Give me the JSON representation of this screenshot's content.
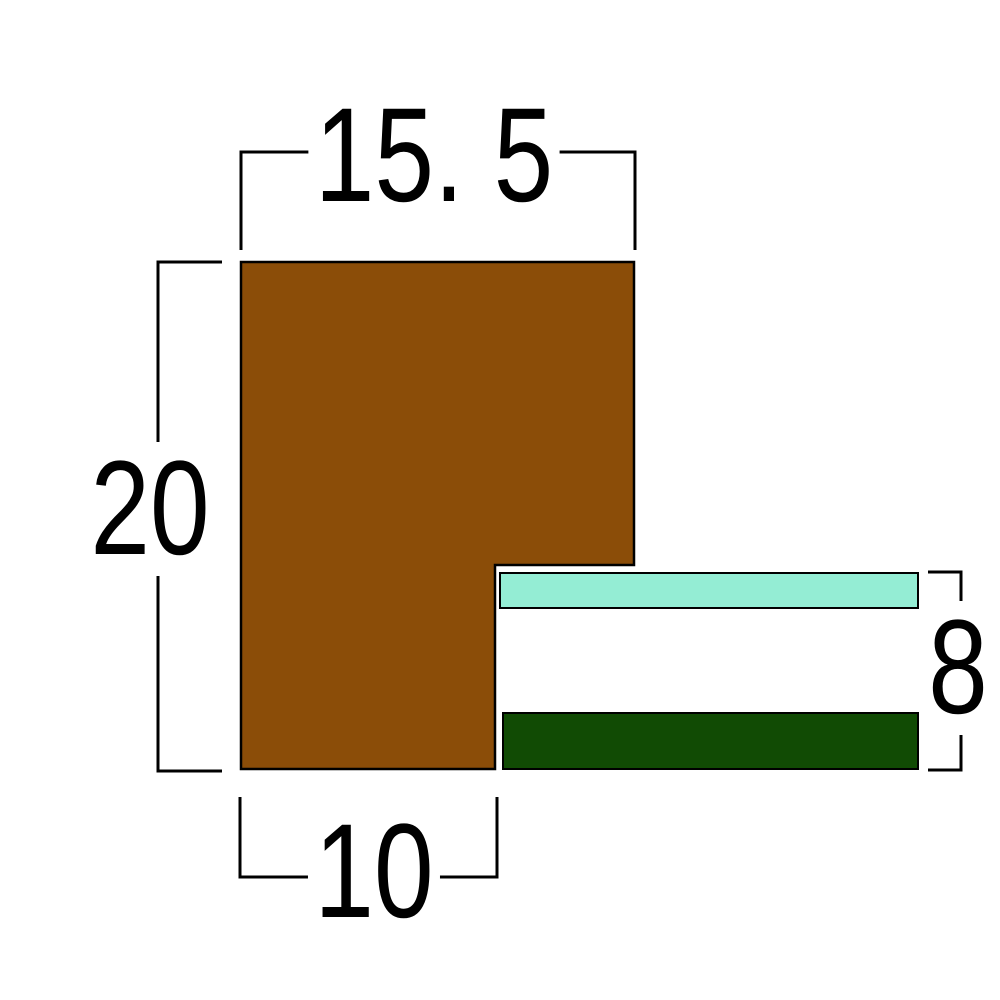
{
  "diagram": {
    "type": "cross-section dimension drawing",
    "dimensions": {
      "top_width": {
        "label": "15. 5"
      },
      "left_height": {
        "label": "20"
      },
      "bottom_width": {
        "label": "10"
      },
      "right_height": {
        "label": "8"
      }
    },
    "colors": {
      "profile_fill": "#8B4D08",
      "top_strip_fill": "#94EDD4",
      "bottom_strip_fill": "#114B04",
      "outline": "#000000",
      "dimension_line": "#000000",
      "background": "#FFFFFF"
    }
  }
}
